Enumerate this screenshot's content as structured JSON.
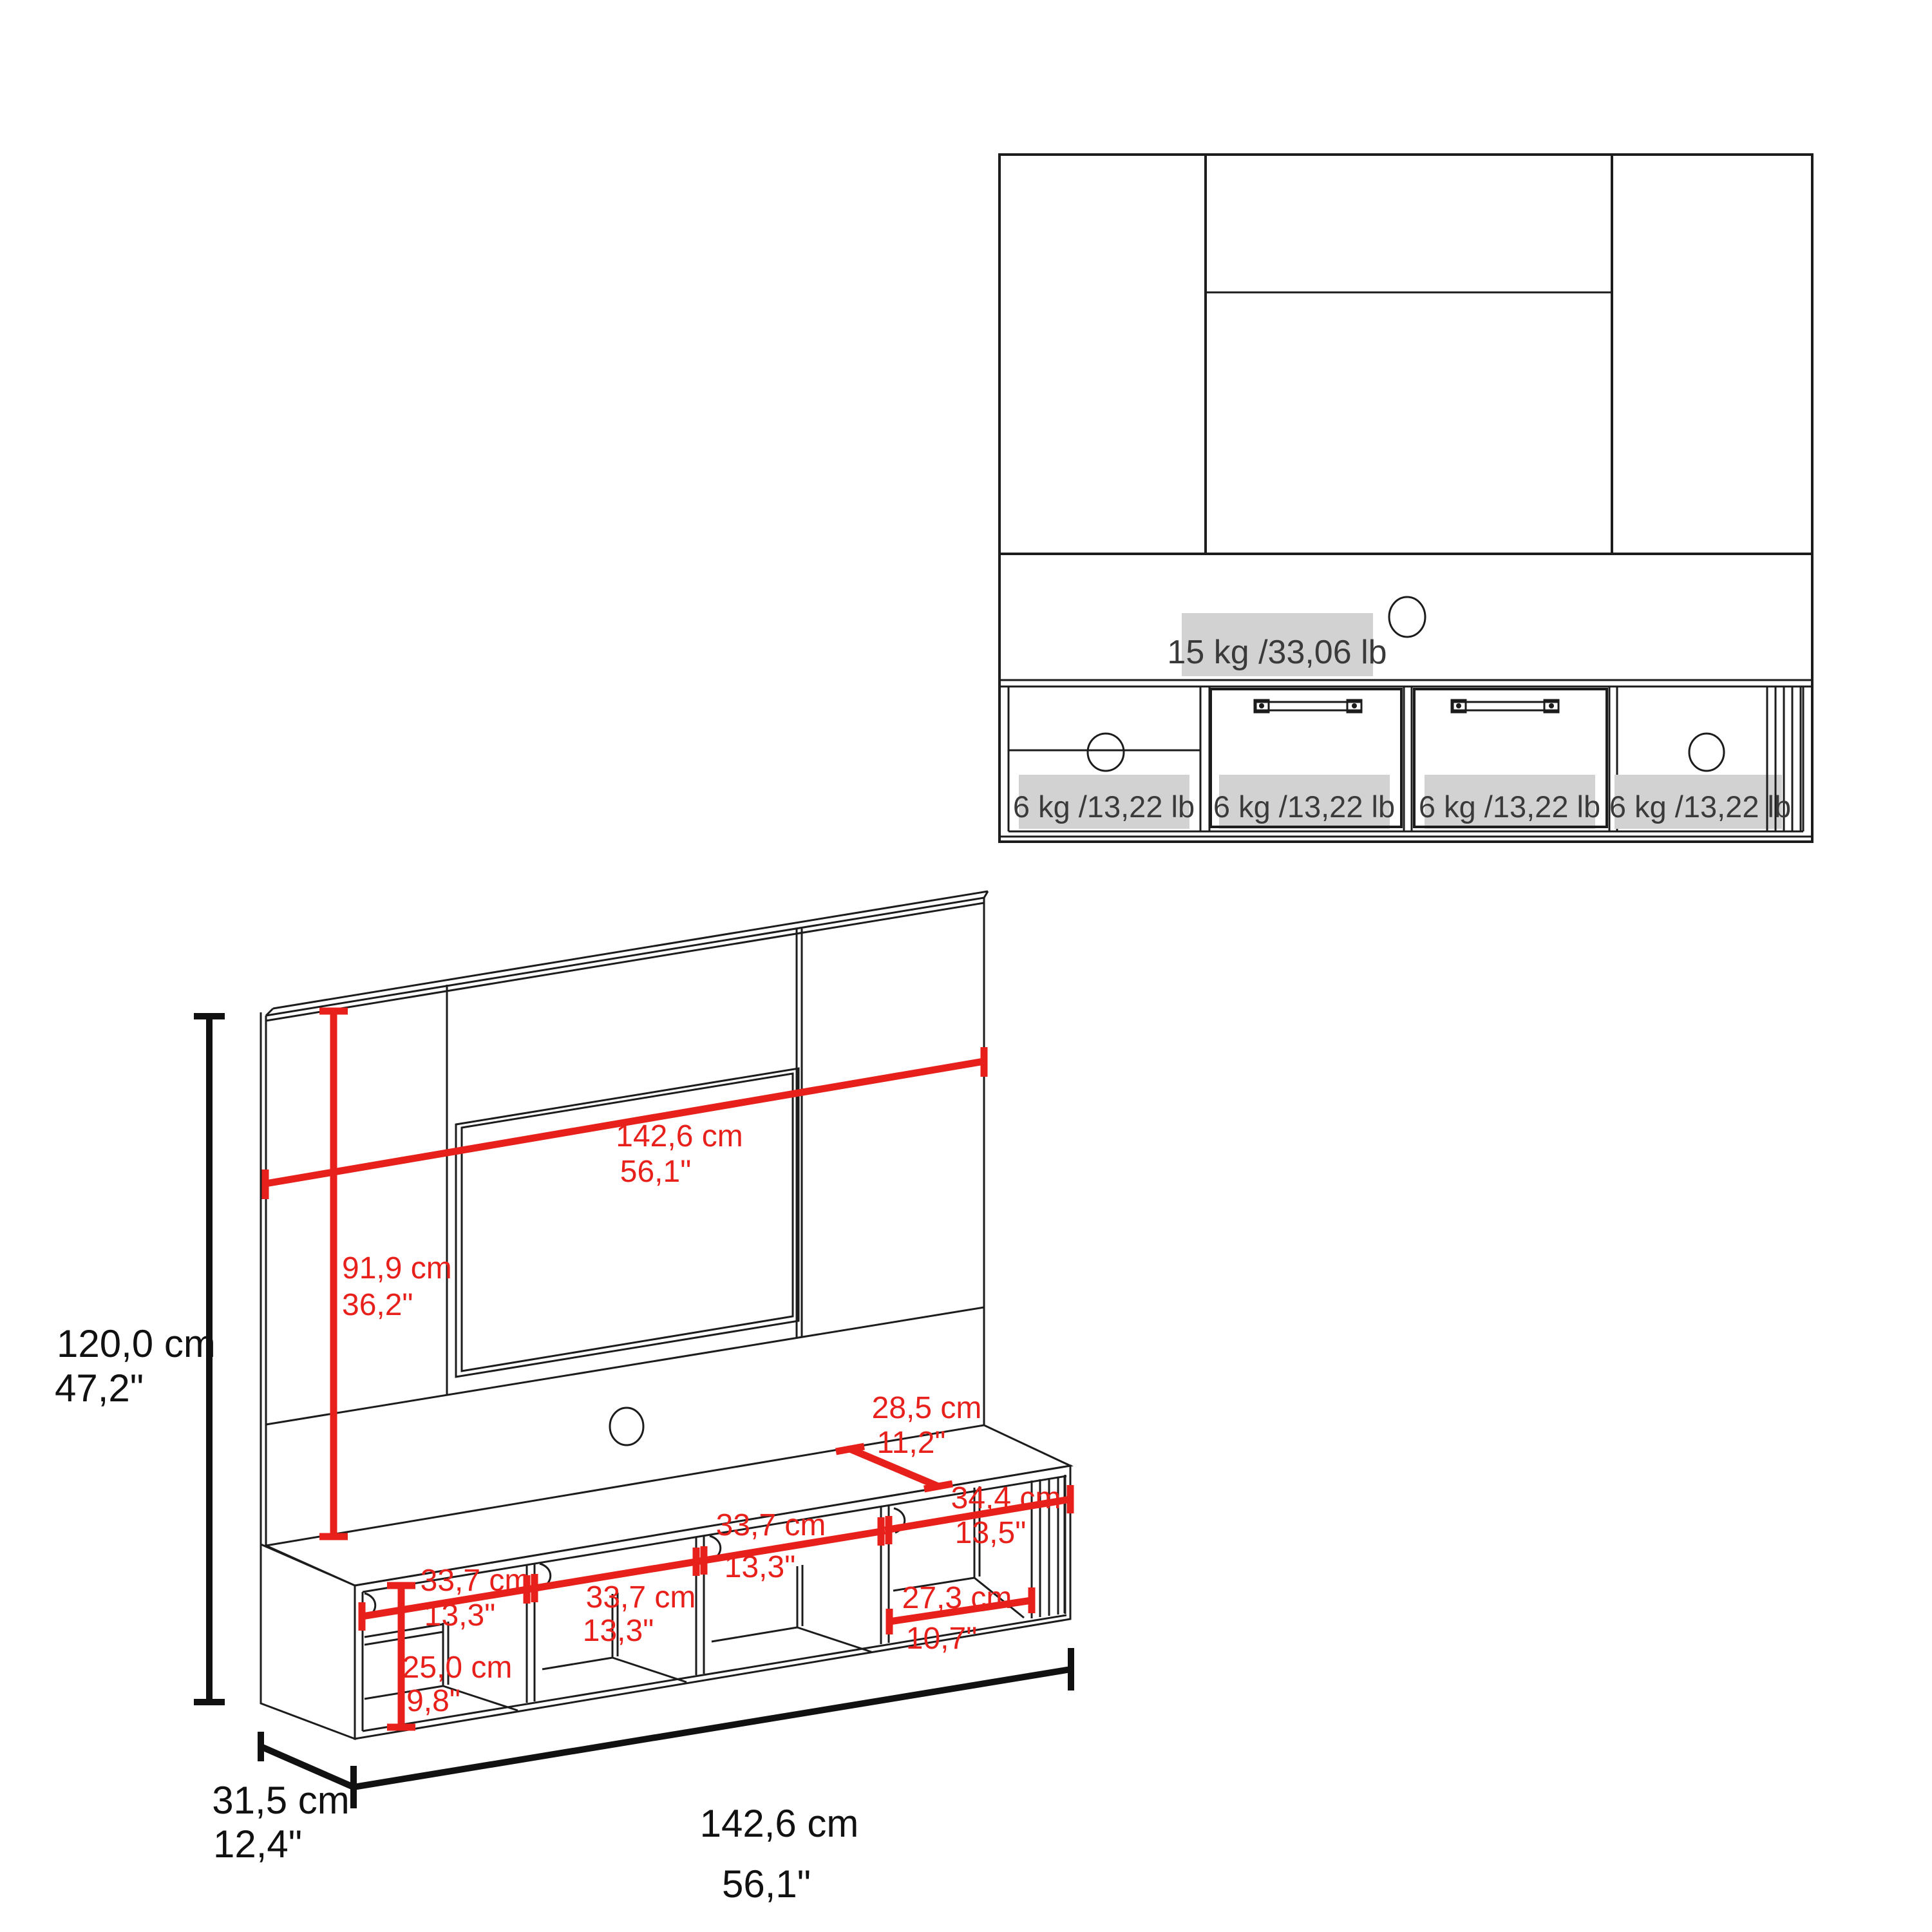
{
  "front_view": {
    "shelf_capacity": "15 kg /33,06 lb",
    "compartment_capacities": [
      "6 kg /13,22 lb",
      "6 kg /13,22 lb",
      "6 kg /13,22 lb",
      "6 kg /13,22 lb"
    ]
  },
  "iso": {
    "height": {
      "cm": "120,0 cm",
      "in": "47,2\""
    },
    "width_top": {
      "cm": "142,6 cm",
      "in": "56,1\""
    },
    "panel_height": {
      "cm": "91,9 cm",
      "in": "36,2\""
    },
    "top_depth": {
      "cm": "28,5 cm",
      "in": "11,2\""
    },
    "end_section": {
      "cm": "34,4 cm",
      "in": "13,5\""
    },
    "cubby1": {
      "cm": "33,7 cm",
      "in": "13,3\""
    },
    "cubby2": {
      "cm": "33,7 cm",
      "in": "13,3\""
    },
    "cubby3": {
      "cm": "33,7 cm",
      "in": "13,3\""
    },
    "end_cubby": {
      "cm": "27,3 cm",
      "in": "10,7\""
    },
    "inner_height": {
      "cm": "25,0 cm",
      "in": "9,8\""
    },
    "width_bottom": {
      "cm": "142,6 cm",
      "in": "56,1\""
    },
    "depth": {
      "cm": "31,5 cm",
      "in": "12,4\""
    }
  },
  "colors": {
    "dimension_red": "#e8201b",
    "outline_black": "#1c1c1c",
    "badge_background": "#d2d2d2",
    "badge_text": "#3a3a3a"
  }
}
